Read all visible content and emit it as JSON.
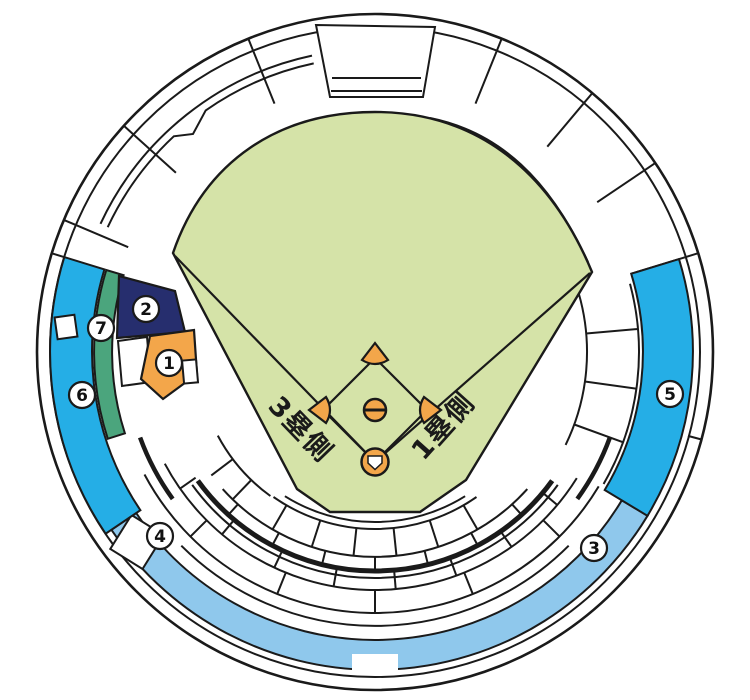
{
  "map": {
    "kind": "baseball-stadium-seating-map",
    "sections": [
      {
        "label": "1"
      },
      {
        "label": "2"
      },
      {
        "label": "3"
      },
      {
        "label": "4"
      },
      {
        "label": "5"
      },
      {
        "label": "6"
      },
      {
        "label": "7"
      }
    ],
    "field": {
      "third_base_side": "3塁側",
      "first_base_side": "1塁側"
    }
  },
  "colors": {
    "outline": "#1a1a1a",
    "field_green": "#d5e3a8",
    "cyan": "#25aee6",
    "light_blue": "#8fc8ec",
    "navy": "#262e6e",
    "green": "#4ba57d",
    "orange": "#f3a64a",
    "white": "#ffffff"
  }
}
